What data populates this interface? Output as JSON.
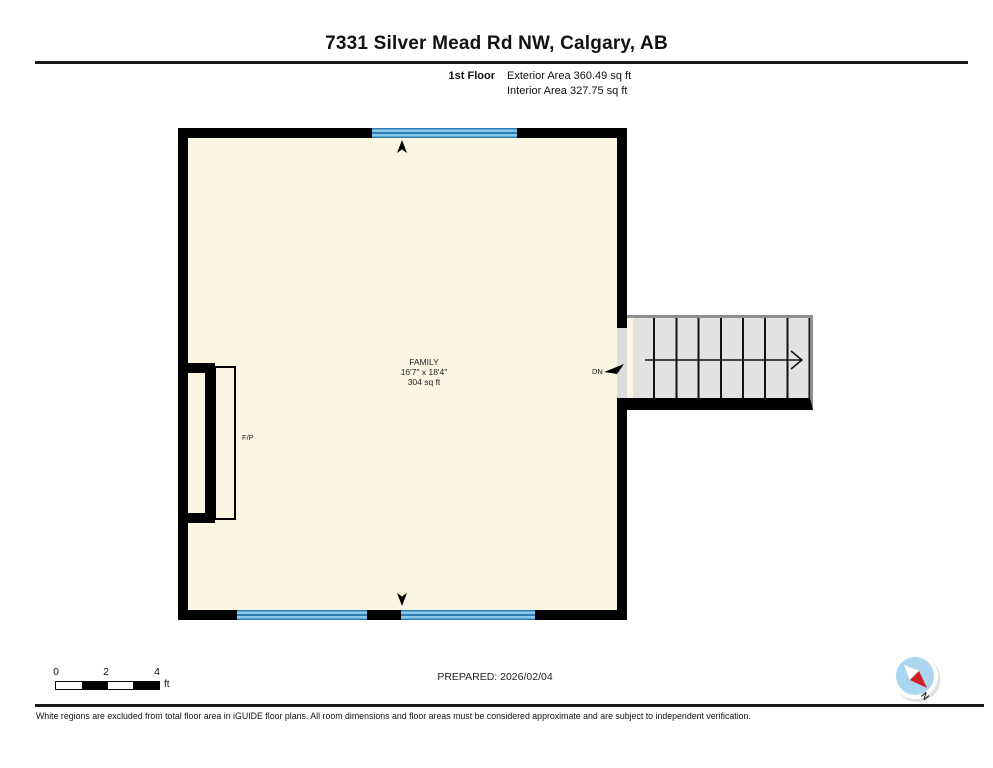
{
  "header": {
    "title": "7331 Silver Mead Rd NW, Calgary, AB",
    "floor_label": "1st Floor",
    "exterior_area": "Exterior Area 360.49 sq ft",
    "interior_area": "Interior Area 327.75 sq ft"
  },
  "floor_plan": {
    "room": {
      "name": "FAMILY",
      "dimensions": "16'7\" x 18'4\"",
      "area": "304 sq ft"
    },
    "fireplace_label": "F/P",
    "stairs_label": "DN",
    "colors": {
      "wall": "#000000",
      "room_fill": "#FBF6E1",
      "window_fill": "#8AC8EA",
      "window_frame": "#2F7CB3",
      "stairs_fill": "#E2E2E2",
      "stairs_border": "#8F8F8F",
      "compass_blue": "#AAD6F0",
      "compass_needle_red": "#D22027"
    }
  },
  "scale_bar": {
    "ticks": [
      "0",
      "2",
      "4"
    ],
    "unit": "ft"
  },
  "footer": {
    "prepared": "PREPARED: 2026/02/04",
    "compass_label": "N",
    "disclaimer": "White regions are excluded from total floor area in iGUIDE floor plans. All room dimensions and floor areas must be considered approximate and are subject to independent verification."
  }
}
